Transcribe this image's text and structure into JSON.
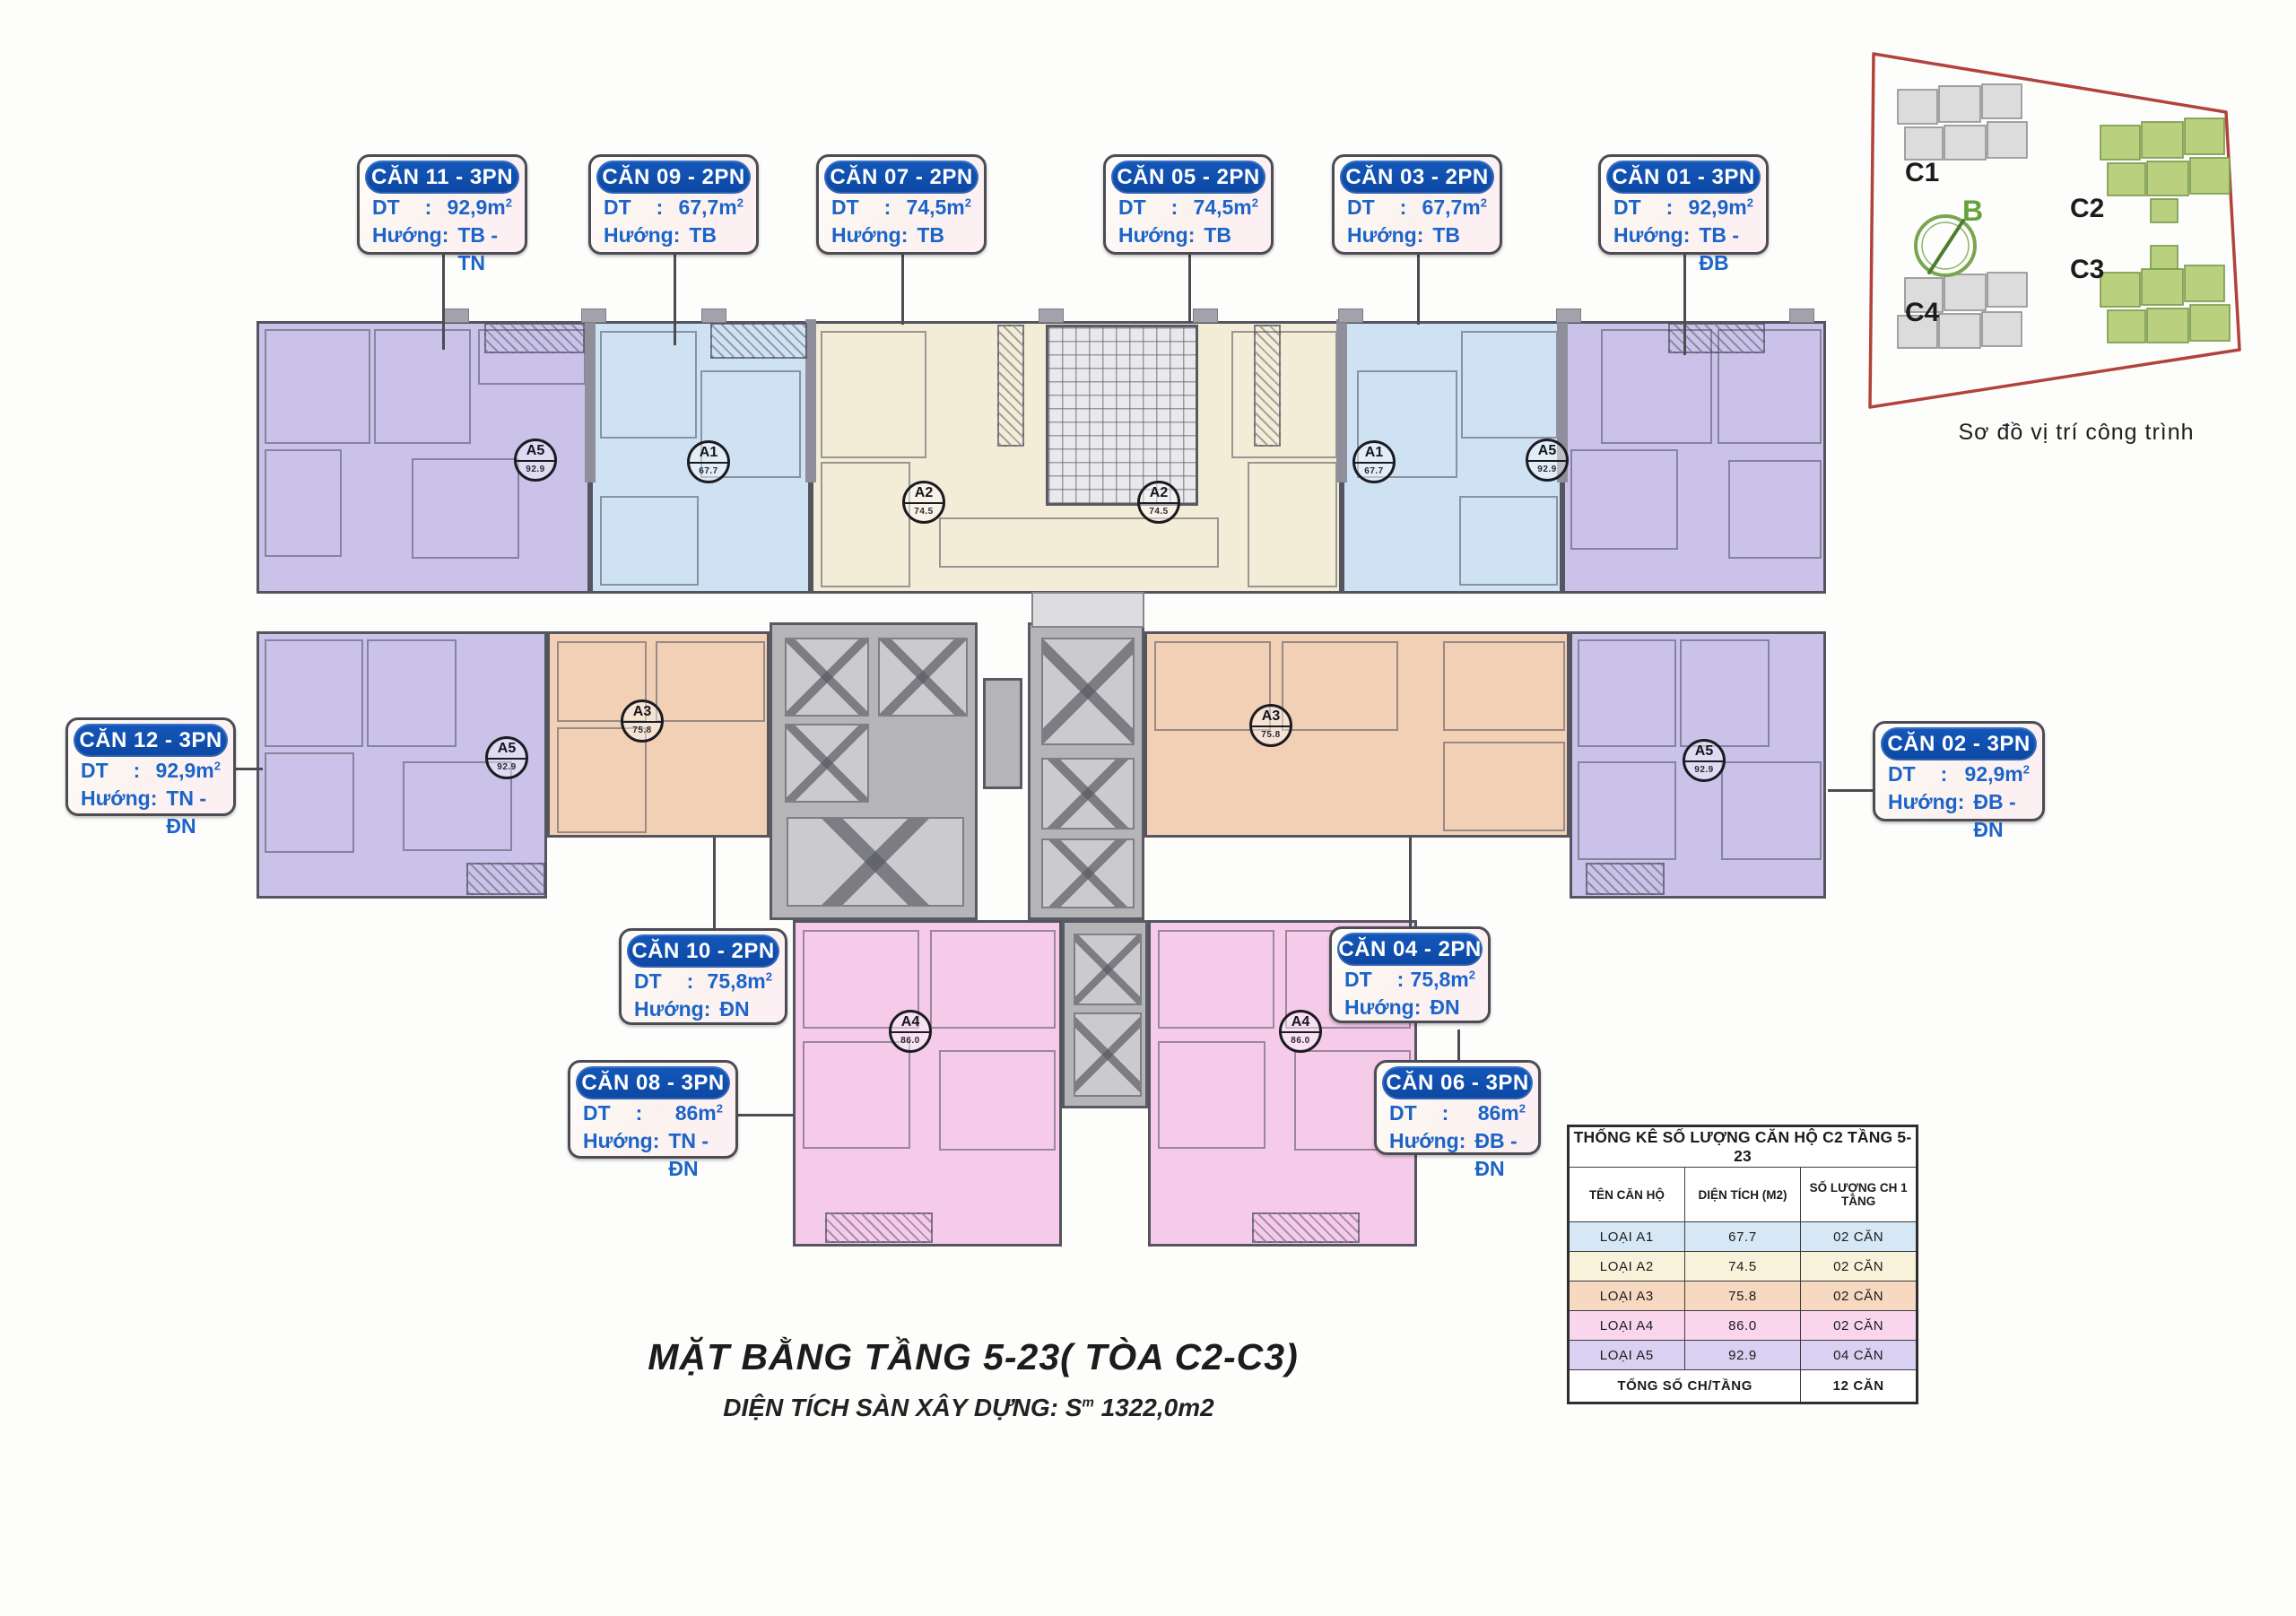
{
  "unit_type_colors": {
    "A1": "#cfe2f3",
    "A2": "#f3ecd6",
    "A3": "#f2d0b6",
    "A4": "#f5cbe9",
    "A5": "#cbc2e9"
  },
  "unit_badges": {
    "A1": "67.7",
    "A2": "74.5",
    "A3": "75.8",
    "A4": "86.0",
    "A5": "92.9"
  },
  "unit_labels": [
    {
      "id": "can-11",
      "title": "CĂN 11 - 3PN",
      "area_label": "DT",
      "colon": ":",
      "area": "92,9m",
      "area_sup": "2",
      "dir_label": "Hướng:",
      "dir": "TB - TN"
    },
    {
      "id": "can-09",
      "title": "CĂN 09 - 2PN",
      "area_label": "DT",
      "colon": ":",
      "area": "67,7m",
      "area_sup": "2",
      "dir_label": "Hướng:",
      "dir": "TB"
    },
    {
      "id": "can-07",
      "title": "CĂN 07 - 2PN",
      "area_label": "DT",
      "colon": ":",
      "area": "74,5m",
      "area_sup": "2",
      "dir_label": "Hướng:",
      "dir": "TB"
    },
    {
      "id": "can-05",
      "title": "CĂN 05 - 2PN",
      "area_label": "DT",
      "colon": ":",
      "area": "74,5m",
      "area_sup": "2",
      "dir_label": "Hướng:",
      "dir": "TB"
    },
    {
      "id": "can-03",
      "title": "CĂN 03 - 2PN",
      "area_label": "DT",
      "colon": ":",
      "area": "67,7m",
      "area_sup": "2",
      "dir_label": "Hướng:",
      "dir": "TB"
    },
    {
      "id": "can-01",
      "title": "CĂN 01 - 3PN",
      "area_label": "DT",
      "colon": ":",
      "area": "92,9m",
      "area_sup": "2",
      "dir_label": "Hướng:",
      "dir": "TB - ĐB"
    },
    {
      "id": "can-12",
      "title": "CĂN 12 - 3PN",
      "area_label": "DT",
      "colon": ":",
      "area": "92,9m",
      "area_sup": "2",
      "dir_label": "Hướng:",
      "dir": "TN - ĐN"
    },
    {
      "id": "can-02",
      "title": "CĂN 02 - 3PN",
      "area_label": "DT",
      "colon": ":",
      "area": "92,9m",
      "area_sup": "2",
      "dir_label": "Hướng:",
      "dir": "ĐB - ĐN"
    },
    {
      "id": "can-10",
      "title": "CĂN 10 - 2PN",
      "area_label": "DT",
      "colon": ":",
      "area": "75,8m",
      "area_sup": "2",
      "dir_label": "Hướng:",
      "dir": "ĐN"
    },
    {
      "id": "can-04",
      "title": "CĂN 04 - 2PN",
      "area_label": "DT",
      "colon": ":",
      "area": "75,8m",
      "area_sup": "2",
      "dir_label": "Hướng:",
      "dir": "ĐN"
    },
    {
      "id": "can-08",
      "title": "CĂN 08 - 3PN",
      "area_label": "DT",
      "colon": ":",
      "area": "86m",
      "area_sup": "2",
      "dir_label": "Hướng:",
      "dir": "TN - ĐN"
    },
    {
      "id": "can-06",
      "title": "CĂN 06 - 3PN",
      "area_label": "DT",
      "colon": ":",
      "area": "86m",
      "area_sup": "2",
      "dir_label": "Hướng:",
      "dir": "ĐB - ĐN"
    }
  ],
  "stats_table": {
    "title": "THỐNG KÊ SỐ LƯỢNG CĂN HỘ C2 TẦNG 5-23",
    "headers": [
      "TÊN CĂN HỘ",
      "DIỆN TÍCH (M2)",
      "SỐ LƯỢNG CH 1 TẦNG"
    ],
    "rows": [
      {
        "name": "LOẠI A1",
        "area": "67.7",
        "count": "02 CĂN",
        "color": "#d6e8f6"
      },
      {
        "name": "LOẠI A2",
        "area": "74.5",
        "count": "02 CĂN",
        "color": "#f9f2da"
      },
      {
        "name": "LOẠI A3",
        "area": "75.8",
        "count": "02 CĂN",
        "color": "#f7d8c0"
      },
      {
        "name": "LOẠI A4",
        "area": "86.0",
        "count": "02 CĂN",
        "color": "#f9d6ee"
      },
      {
        "name": "LOẠI A5",
        "area": "92.9",
        "count": "04 CĂN",
        "color": "#d9d0f2"
      }
    ],
    "total_label": "TỔNG SỐ CH/TẦNG",
    "total_value": "12 CĂN"
  },
  "site_diagram": {
    "caption": "Sơ đồ vị trí công trình",
    "compass_label": "B",
    "outline_color": "#b2423c",
    "green_fill": "#b9d07f",
    "green_stroke": "#77994a",
    "gray_fill": "#dcdcdc",
    "gray_stroke": "#8f8f8f",
    "buildings": [
      {
        "label": "C1",
        "kind": "gray"
      },
      {
        "label": "C2",
        "kind": "green"
      },
      {
        "label": "C3",
        "kind": "green"
      },
      {
        "label": "C4",
        "kind": "gray"
      }
    ]
  },
  "floor_title": {
    "line1": "MẶT BẰNG TẦNG 5-23( TÒA C2-C3)",
    "line2_prefix": "DIỆN TÍCH SÀN XÂY DỰNG: S",
    "line2_sub": "m",
    "line2_value": "1322,0m2"
  }
}
